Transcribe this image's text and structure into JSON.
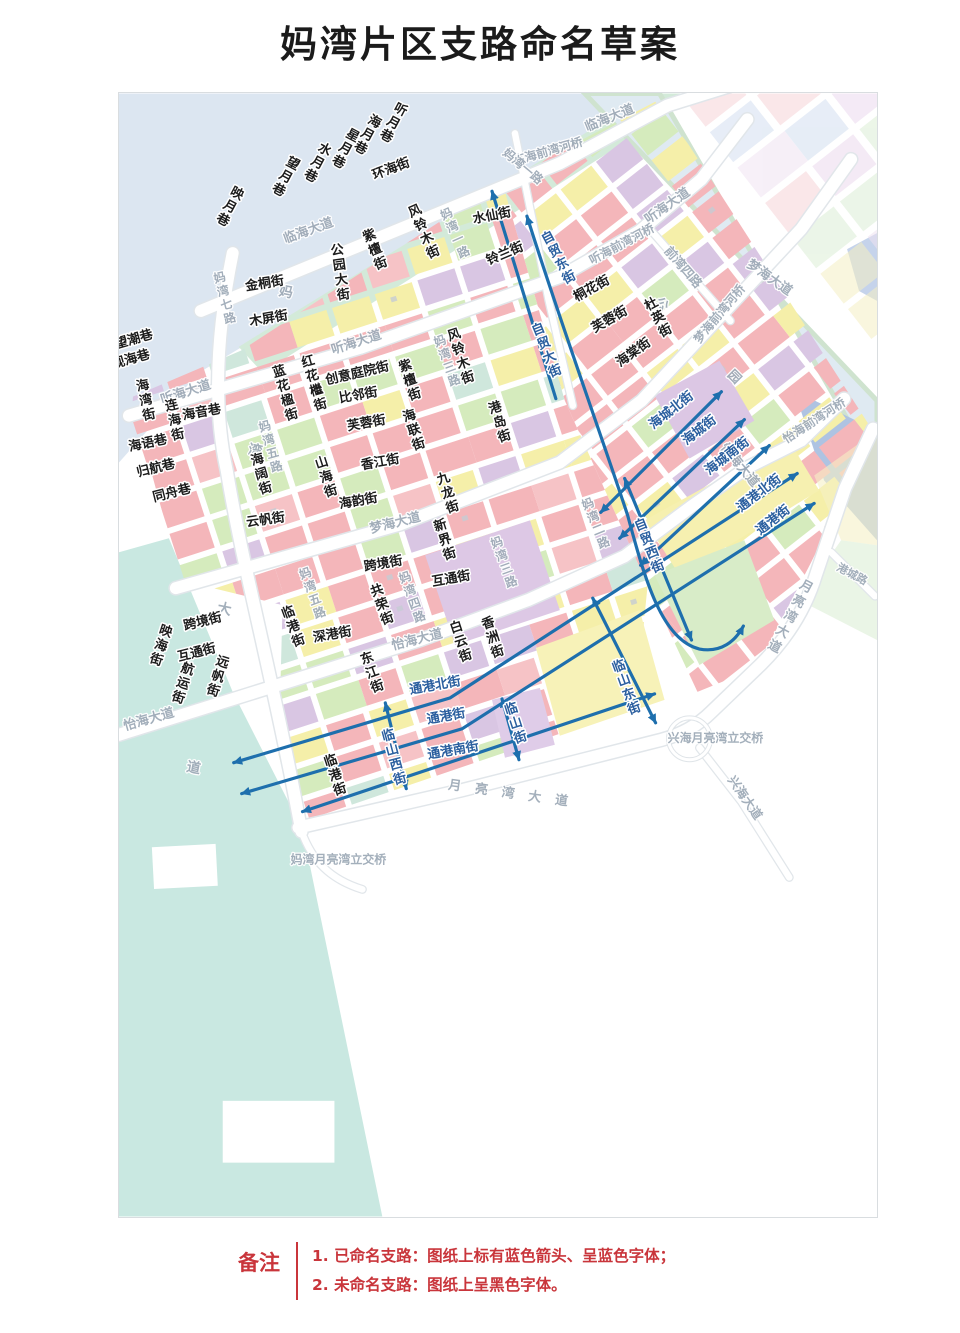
{
  "title": "妈湾片区支路命名草案",
  "legend": {
    "label": "备注",
    "notes": [
      "1. 已命名支路：图纸上标有蓝色箭头、呈蓝色字体；",
      "2. 未命名支路：图纸上呈黑色字体。"
    ],
    "text_color": "#c9353b"
  },
  "colors": {
    "named_street_text": "#2b5f9f",
    "unnamed_street_text": "#1c1c1c",
    "road_text": "#9fabb8",
    "arrow": "#1e6fad",
    "water": "#dce6f1",
    "harbor": "#c9e8e1",
    "parcel_pink": "#f4b6ba",
    "parcel_yellow": "#f5efa9",
    "parcel_green": "#d5ebbd",
    "parcel_purple": "#d9c6e3"
  },
  "map": {
    "named_streets": [
      {
        "t": "自贸东街",
        "x": 559,
        "y": 257,
        "v": 1,
        "r": -28
      },
      {
        "t": "自贸大街",
        "x": 547,
        "y": 350,
        "v": 1,
        "r": -22
      },
      {
        "t": "自贸西街",
        "x": 650,
        "y": 546,
        "v": 1,
        "r": -22
      },
      {
        "t": "海城北街",
        "x": 672,
        "y": 410,
        "r": -38
      },
      {
        "t": "海城街",
        "x": 700,
        "y": 430,
        "r": -38
      },
      {
        "t": "海城南街",
        "x": 728,
        "y": 456,
        "r": -38
      },
      {
        "t": "通港北街",
        "x": 760,
        "y": 493,
        "r": -38
      },
      {
        "t": "通港街",
        "x": 774,
        "y": 520,
        "r": -38
      },
      {
        "t": "通港北街",
        "x": 435,
        "y": 686,
        "r": -10
      },
      {
        "t": "通港街",
        "x": 446,
        "y": 717,
        "r": -10
      },
      {
        "t": "通港南街",
        "x": 453,
        "y": 751,
        "r": -10
      },
      {
        "t": "临山西街",
        "x": 394,
        "y": 758,
        "v": 1,
        "r": -15
      },
      {
        "t": "临山街",
        "x": 516,
        "y": 724,
        "v": 1,
        "r": -18
      },
      {
        "t": "临山东街",
        "x": 627,
        "y": 688,
        "v": 1,
        "r": -20
      }
    ],
    "unnamed_streets": [
      {
        "t": "听月巷",
        "x": 393,
        "y": 122,
        "v": 1,
        "r": 28
      },
      {
        "t": "海月巷",
        "x": 367,
        "y": 134,
        "v": 1,
        "r": 28
      },
      {
        "t": "星月巷",
        "x": 345,
        "y": 148,
        "v": 1,
        "r": 28
      },
      {
        "t": "水月巷",
        "x": 317,
        "y": 162,
        "v": 1,
        "r": 28
      },
      {
        "t": "望月巷",
        "x": 285,
        "y": 176,
        "v": 1,
        "r": 28
      },
      {
        "t": "映月巷",
        "x": 229,
        "y": 206,
        "v": 1,
        "r": 28
      },
      {
        "t": "环海街",
        "x": 391,
        "y": 168,
        "r": -21
      },
      {
        "t": "望潮巷",
        "x": 133,
        "y": 339,
        "r": -16
      },
      {
        "t": "观海巷",
        "x": 130,
        "y": 359,
        "r": -16
      },
      {
        "t": "海湾街",
        "x": 145,
        "y": 400,
        "v": 1,
        "r": -12
      },
      {
        "t": "连海街",
        "x": 174,
        "y": 420,
        "v": 1,
        "r": -12
      },
      {
        "t": "海音巷",
        "x": 201,
        "y": 412,
        "r": -10
      },
      {
        "t": "海语巷",
        "x": 147,
        "y": 443,
        "r": -12
      },
      {
        "t": "归航巷",
        "x": 155,
        "y": 468,
        "r": -14
      },
      {
        "t": "同舟巷",
        "x": 171,
        "y": 493,
        "r": -14
      },
      {
        "t": "映海街",
        "x": 160,
        "y": 646,
        "v": 1,
        "r": 18
      },
      {
        "t": "跨境街",
        "x": 202,
        "y": 622,
        "r": -14
      },
      {
        "t": "互通街",
        "x": 196,
        "y": 653,
        "r": -14
      },
      {
        "t": "航运街",
        "x": 182,
        "y": 684,
        "v": 1,
        "r": 18
      },
      {
        "t": "远帆街",
        "x": 217,
        "y": 677,
        "v": 1,
        "r": 18
      },
      {
        "t": "金桐街",
        "x": 264,
        "y": 283,
        "r": -9
      },
      {
        "t": "木屏街",
        "x": 268,
        "y": 318,
        "r": -10
      },
      {
        "t": "公园大街",
        "x": 340,
        "y": 272,
        "v": 1,
        "r": -8
      },
      {
        "t": "紫檀街",
        "x": 375,
        "y": 249,
        "v": 1,
        "r": -22
      },
      {
        "t": "风铃木街",
        "x": 424,
        "y": 231,
        "v": 1,
        "r": -24
      },
      {
        "t": "水仙街",
        "x": 492,
        "y": 215,
        "r": -11
      },
      {
        "t": "铃兰街",
        "x": 505,
        "y": 253,
        "r": -23
      },
      {
        "t": "桐花街",
        "x": 592,
        "y": 288,
        "r": -29
      },
      {
        "t": "芙蓉街",
        "x": 610,
        "y": 319,
        "r": -30
      },
      {
        "t": "海棠街",
        "x": 634,
        "y": 352,
        "r": -36
      },
      {
        "t": "杜英街",
        "x": 659,
        "y": 317,
        "v": 1,
        "r": -28
      },
      {
        "t": "蓝花楹街",
        "x": 285,
        "y": 393,
        "v": 1,
        "r": -16
      },
      {
        "t": "红花檵街",
        "x": 314,
        "y": 383,
        "v": 1,
        "r": -16
      },
      {
        "t": "创意庭院街",
        "x": 357,
        "y": 373,
        "r": -13
      },
      {
        "t": "比邻街",
        "x": 358,
        "y": 395,
        "r": -10
      },
      {
        "t": "芙蓉街",
        "x": 366,
        "y": 423,
        "r": -10
      },
      {
        "t": "紫檀街",
        "x": 410,
        "y": 380,
        "v": 1,
        "r": -18
      },
      {
        "t": "海联街",
        "x": 414,
        "y": 430,
        "v": 1,
        "r": -18
      },
      {
        "t": "风铃木街",
        "x": 461,
        "y": 356,
        "v": 1,
        "r": -18
      },
      {
        "t": "港岛街",
        "x": 500,
        "y": 422,
        "v": 1,
        "r": -18
      },
      {
        "t": "海阔街",
        "x": 261,
        "y": 474,
        "v": 1,
        "r": -16
      },
      {
        "t": "山海街",
        "x": 326,
        "y": 477,
        "v": 1,
        "r": -18
      },
      {
        "t": "香江街",
        "x": 380,
        "y": 462,
        "r": -10
      },
      {
        "t": "九龙街",
        "x": 448,
        "y": 493,
        "v": 1,
        "r": -18
      },
      {
        "t": "海韵街",
        "x": 358,
        "y": 501,
        "r": -10
      },
      {
        "t": "云帆街",
        "x": 265,
        "y": 520,
        "r": -8
      },
      {
        "t": "新界街",
        "x": 445,
        "y": 540,
        "v": 1,
        "r": -18
      },
      {
        "t": "跨境街",
        "x": 383,
        "y": 564,
        "r": -10
      },
      {
        "t": "互通街",
        "x": 451,
        "y": 579,
        "r": -10
      },
      {
        "t": "共荣街",
        "x": 382,
        "y": 605,
        "v": 1,
        "r": -20
      },
      {
        "t": "临港街",
        "x": 293,
        "y": 627,
        "v": 1,
        "r": -20
      },
      {
        "t": "深港街",
        "x": 332,
        "y": 635,
        "r": -10
      },
      {
        "t": "东江街",
        "x": 372,
        "y": 673,
        "v": 1,
        "r": -20
      },
      {
        "t": "白云街",
        "x": 461,
        "y": 642,
        "v": 1,
        "r": -18
      },
      {
        "t": "香洲街",
        "x": 493,
        "y": 638,
        "v": 1,
        "r": -18
      },
      {
        "t": "临港街",
        "x": 335,
        "y": 776,
        "v": 1,
        "r": -18
      }
    ],
    "roads": [
      {
        "t": "临海大道",
        "x": 308,
        "y": 230,
        "r": -20
      },
      {
        "t": "临海大道",
        "x": 610,
        "y": 117,
        "r": -22
      },
      {
        "t": "临海前湾河桥",
        "x": 548,
        "y": 150,
        "r": -16,
        "fs": 12
      },
      {
        "t": "听海大道",
        "x": 185,
        "y": 392,
        "r": -18
      },
      {
        "t": "听海大道",
        "x": 356,
        "y": 342,
        "r": -18
      },
      {
        "t": "听海大道",
        "x": 668,
        "y": 205,
        "r": -35
      },
      {
        "t": "听海前湾河桥",
        "x": 622,
        "y": 243,
        "r": -28,
        "fs": 12
      },
      {
        "t": "前湾四路",
        "x": 684,
        "y": 266,
        "r": 49,
        "fs": 12.5
      },
      {
        "t": "梦海大道",
        "x": 395,
        "y": 523,
        "r": -14
      },
      {
        "t": "梦海大道",
        "x": 770,
        "y": 277,
        "r": 35
      },
      {
        "t": "梦海前湾河桥",
        "x": 720,
        "y": 313,
        "r": -50,
        "fs": 12
      },
      {
        "t": "怡海大道",
        "x": 148,
        "y": 720,
        "r": -16
      },
      {
        "t": "怡海大道",
        "x": 417,
        "y": 640,
        "r": -14
      },
      {
        "t": "怡海大道",
        "x": 740,
        "y": 465,
        "r": 50
      },
      {
        "t": "怡海前湾河桥",
        "x": 815,
        "y": 420,
        "r": -33,
        "fs": 12
      },
      {
        "t": "妈湾大道",
        "x": 239,
        "y": 530,
        "v": 1,
        "r": 11,
        "sp": 148,
        "fs": 14
      },
      {
        "t": "月亮湾大道",
        "x": 791,
        "y": 617,
        "v": 1,
        "r": 28,
        "sp": 4
      },
      {
        "t": "月亮湾大道",
        "x": 515,
        "y": 795,
        "r": 8,
        "sp": 14
      },
      {
        "t": "兴海大道",
        "x": 746,
        "y": 798,
        "r": 55,
        "fs": 12.5
      },
      {
        "t": "港城路",
        "x": 853,
        "y": 574,
        "r": 28,
        "fs": 11
      },
      {
        "t": "兴海月亮湾立交桥",
        "x": 716,
        "y": 738,
        "r": 0,
        "fs": 12
      },
      {
        "t": "妈湾月亮湾立交桥",
        "x": 338,
        "y": 860,
        "r": 0,
        "fs": 12
      },
      {
        "t": "妈湾一路",
        "x": 523,
        "y": 165,
        "r": 40,
        "fs": 12
      },
      {
        "t": "妈湾一路",
        "x": 455,
        "y": 232,
        "v": 1,
        "r": -24,
        "fs": 12
      },
      {
        "t": "妈湾二路",
        "x": 596,
        "y": 523,
        "v": 1,
        "r": -22,
        "fs": 12
      },
      {
        "t": "妈湾三路",
        "x": 504,
        "y": 562,
        "v": 1,
        "r": -20,
        "fs": 12
      },
      {
        "t": "妈湾三路",
        "x": 447,
        "y": 360,
        "v": 1,
        "r": -20,
        "fs": 12
      },
      {
        "t": "妈湾四路",
        "x": 412,
        "y": 597,
        "v": 1,
        "r": -20,
        "fs": 12
      },
      {
        "t": "妈湾五路",
        "x": 270,
        "y": 446,
        "v": 1,
        "r": -16,
        "fs": 12
      },
      {
        "t": "妈湾五路",
        "x": 312,
        "y": 593,
        "v": 1,
        "r": -20,
        "fs": 12
      },
      {
        "t": "妈湾七路",
        "x": 224,
        "y": 297,
        "v": 1,
        "r": -14,
        "fs": 12
      },
      {
        "t": "公园",
        "x": 730,
        "y": 372,
        "r": 45,
        "sp": 90,
        "fs": 13
      }
    ]
  }
}
